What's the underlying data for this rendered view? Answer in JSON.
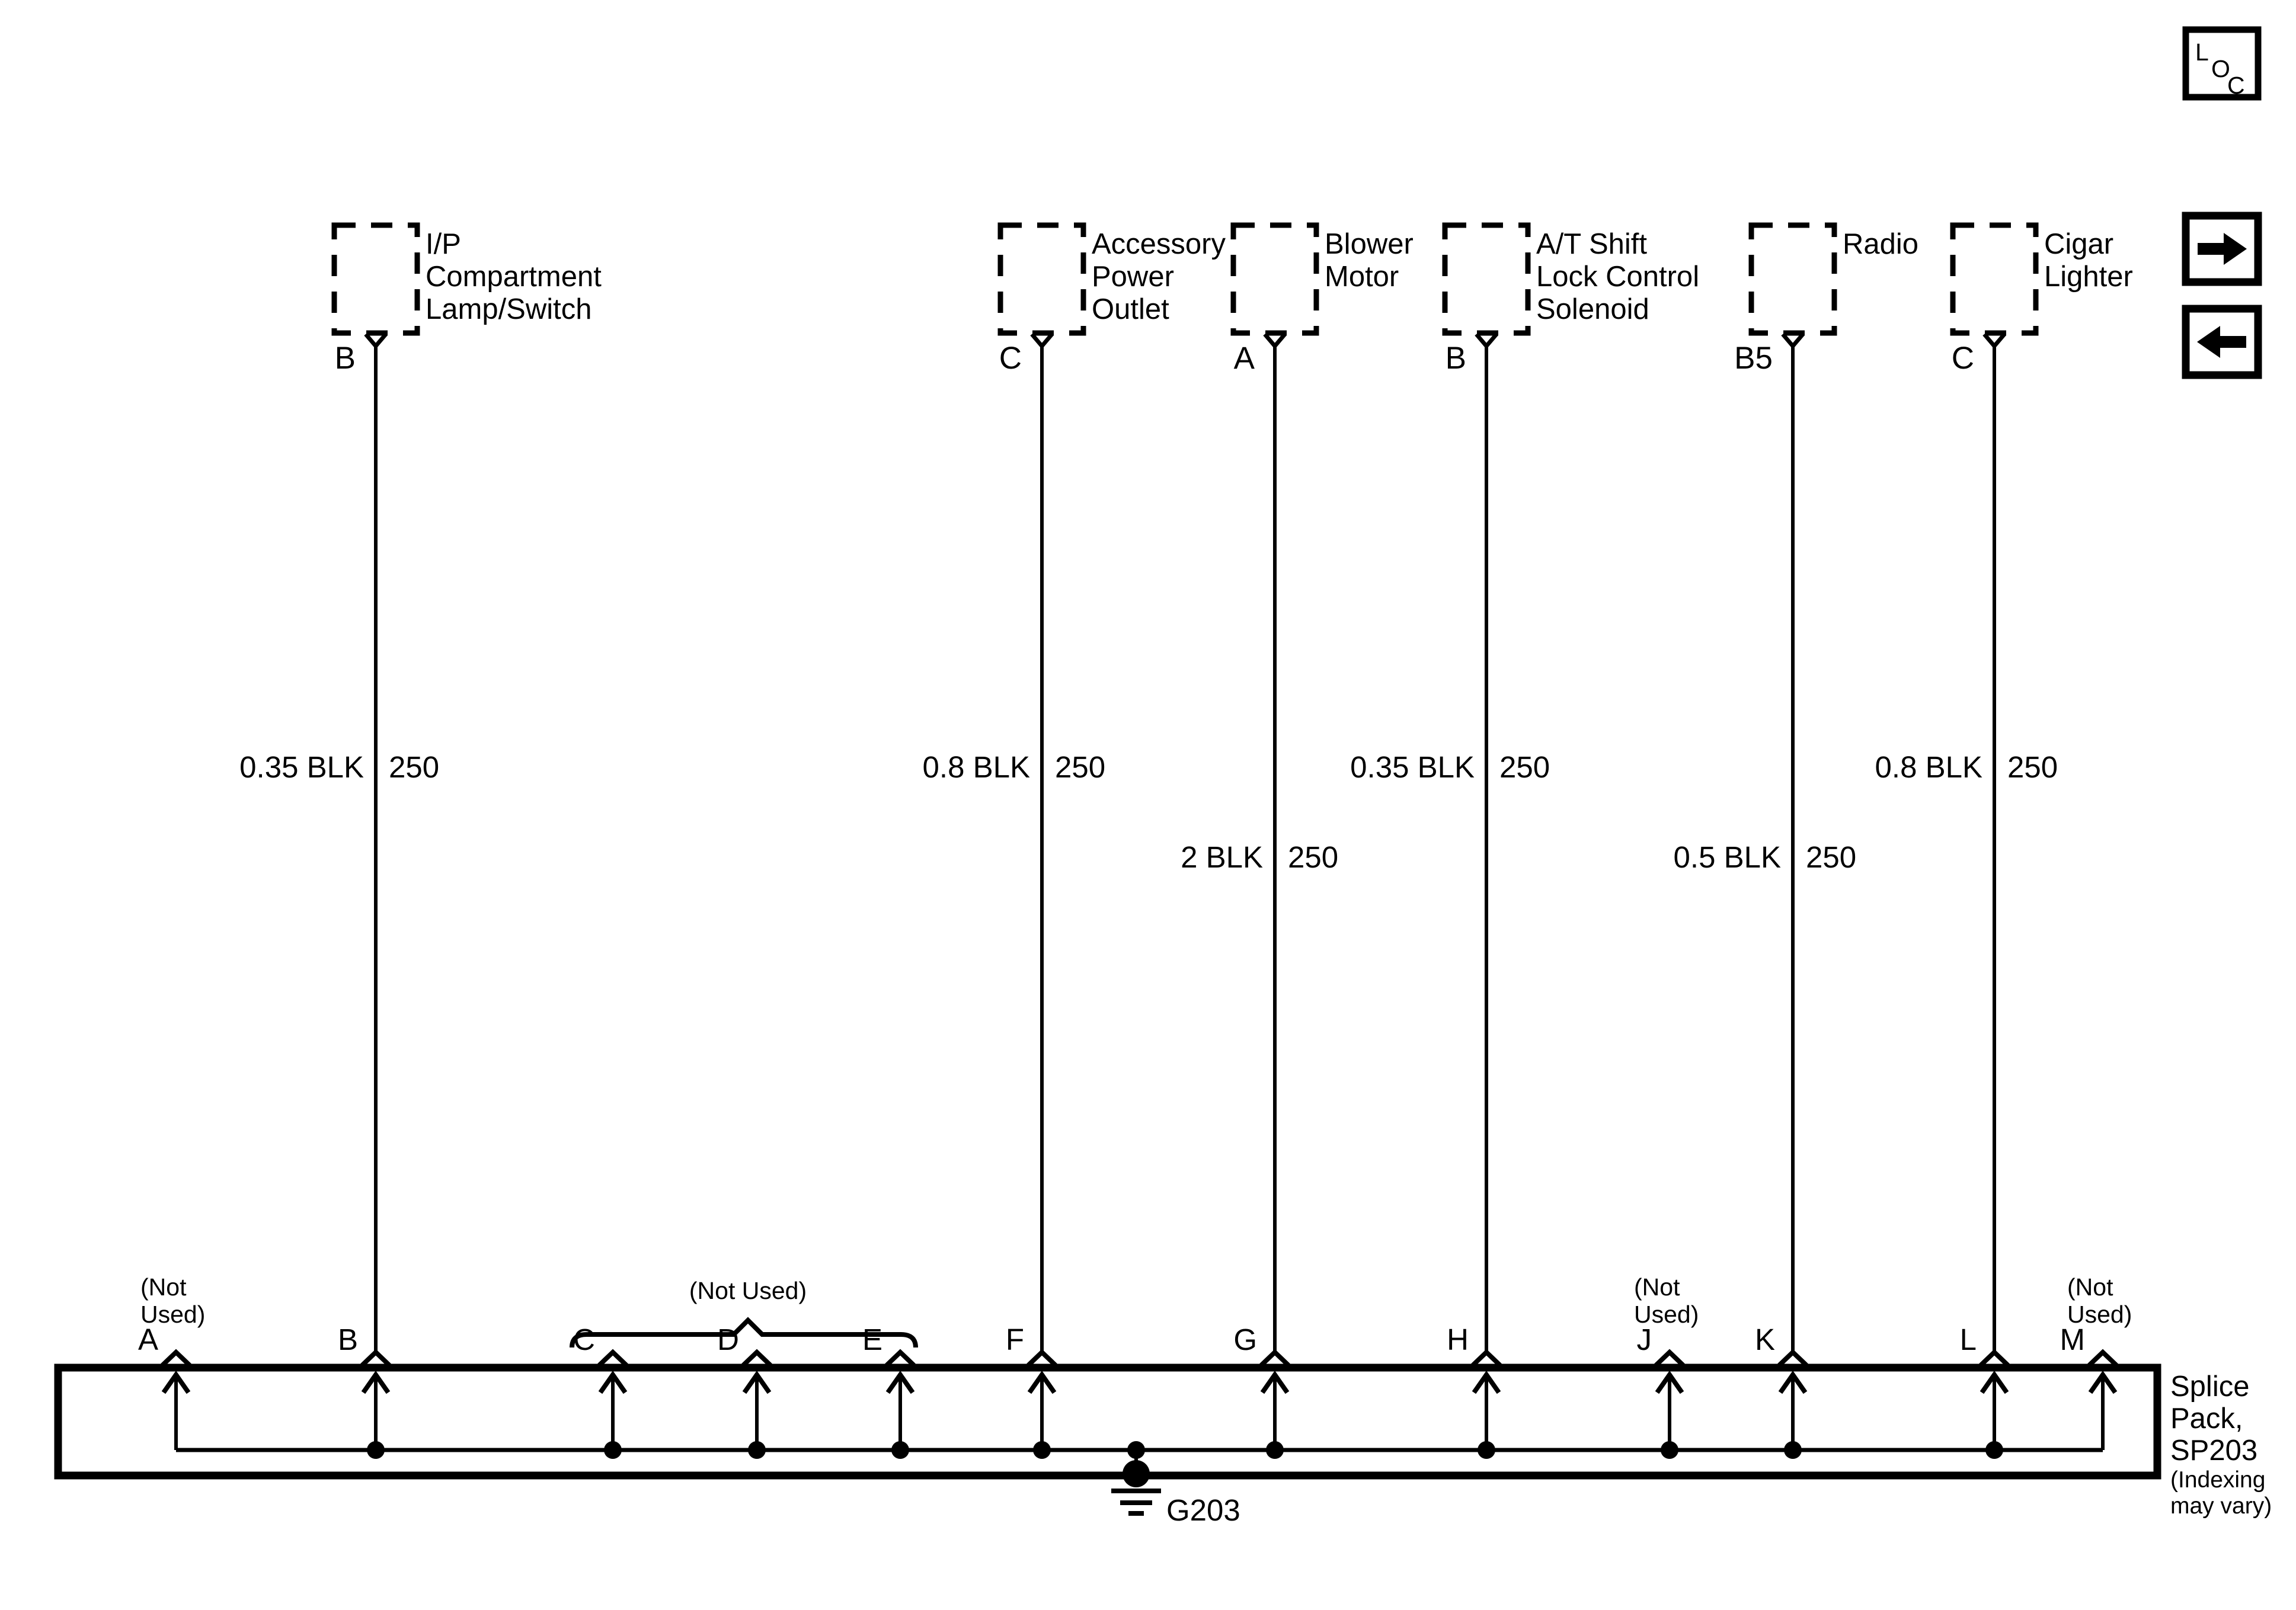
{
  "page": {
    "background": "#ffffff",
    "line_color": "#000000"
  },
  "legend": {
    "loc_letters": [
      "L",
      "O",
      "C"
    ]
  },
  "nav": {
    "forward_icon": "right-arrow",
    "back_icon": "left-arrow"
  },
  "components": [
    {
      "name": "I/P Compartment Lamp/Switch",
      "label_lines": [
        "I/P",
        "Compartment",
        "Lamp/Switch"
      ],
      "pin": "B",
      "wire_label": "0.35 BLK",
      "circuit": "250",
      "splice_pin": "B"
    },
    {
      "name": "Accessory Power Outlet",
      "label_lines": [
        "Accessory",
        "Power",
        "Outlet"
      ],
      "pin": "C",
      "wire_label": "0.8 BLK",
      "circuit": "250",
      "splice_pin": "F"
    },
    {
      "name": "Blower Motor",
      "label_lines": [
        "Blower",
        "Motor"
      ],
      "pin": "A",
      "wire_label": "2 BLK",
      "circuit": "250",
      "splice_pin": "G"
    },
    {
      "name": "A/T Shift Lock Control Solenoid",
      "label_lines": [
        "A/T Shift",
        "Lock Control",
        "Solenoid"
      ],
      "pin": "B",
      "wire_label": "0.35 BLK",
      "circuit": "250",
      "splice_pin": "H"
    },
    {
      "name": "Radio",
      "label_lines": [
        "Radio"
      ],
      "pin": "B5",
      "wire_label": "0.5 BLK",
      "circuit": "250",
      "splice_pin": "K"
    },
    {
      "name": "Cigar Lighter",
      "label_lines": [
        "Cigar",
        "Lighter"
      ],
      "pin": "C",
      "wire_label": "0.8 BLK",
      "circuit": "250",
      "splice_pin": "L"
    }
  ],
  "splice_pack": {
    "label_lines": [
      "Splice",
      "Pack,",
      "SP203"
    ],
    "note_lines": [
      "(Indexing",
      "may vary)"
    ],
    "pins": [
      "A",
      "B",
      "C",
      "D",
      "E",
      "F",
      "G",
      "H",
      "J",
      "K",
      "L",
      "M"
    ],
    "not_used_lines": [
      "(Not",
      "Used)"
    ],
    "not_used_group_label": "(Not Used)",
    "ground_label": "G203"
  }
}
